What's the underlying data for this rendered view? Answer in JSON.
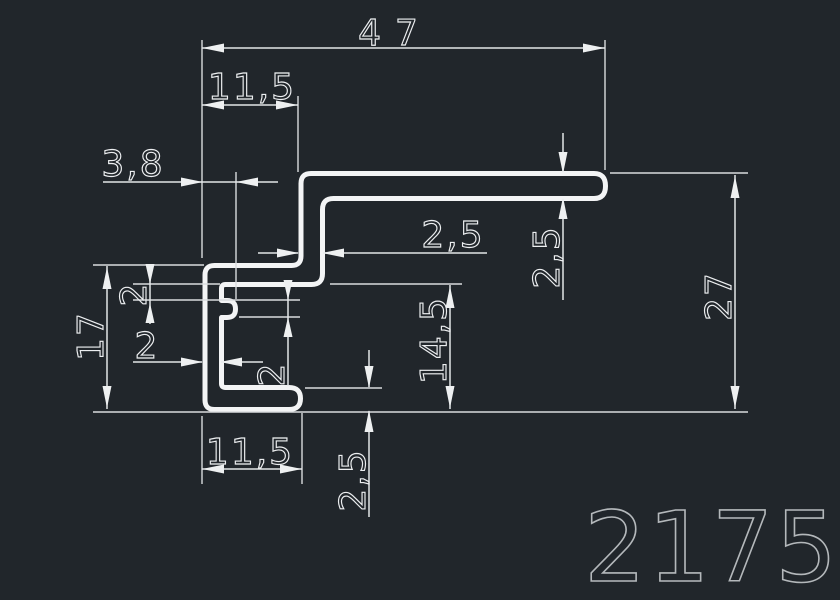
{
  "drawing": {
    "part_number": "2175",
    "dimensions": {
      "overall_width": "47",
      "top_offset": "11,5",
      "rib_offset": "3,8",
      "web_thickness": "2,5",
      "flange_thickness": "2,5",
      "overall_height": "27",
      "channel_height": "17",
      "rib_gap": "2",
      "wall_thickness": "2",
      "rib_height": "2",
      "inner_height": "14,5",
      "bottom_thickness": "2,5",
      "bottom_width": "11,5"
    },
    "colors": {
      "background": "#21262b",
      "lines": "#e3e6e8",
      "profile": "#f3f4f5",
      "title": "#b4b8bb"
    }
  }
}
